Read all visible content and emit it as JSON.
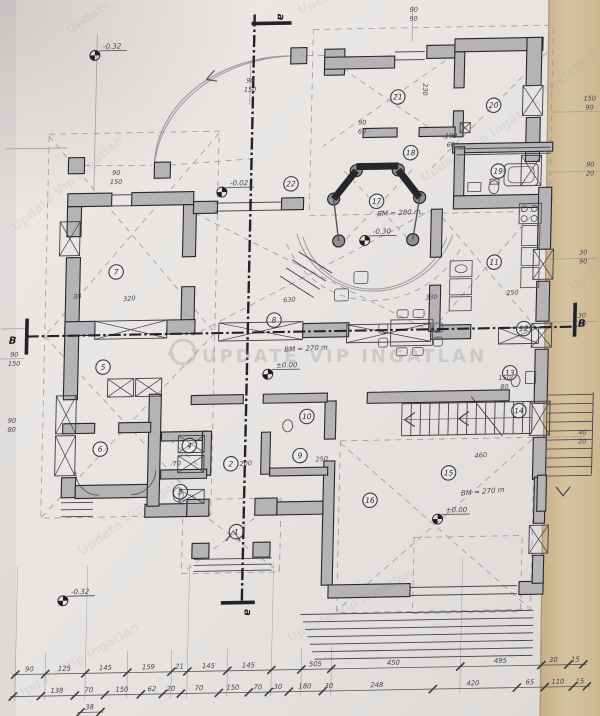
{
  "document": {
    "type_note": "scanned architectural ground floor plan photo",
    "watermark": {
      "center": "UPDATE VIP INGATLAN",
      "tile": "Update Vip Ingatlan",
      "tiles": [
        {
          "x": 70,
          "y": 35,
          "r": -35
        },
        {
          "x": 300,
          "y": 14,
          "r": -24
        },
        {
          "x": 548,
          "y": 95,
          "r": -38
        },
        {
          "x": 16,
          "y": 232,
          "r": -40
        },
        {
          "x": 574,
          "y": 292,
          "r": -40
        },
        {
          "x": 82,
          "y": 556,
          "r": -36
        },
        {
          "x": 424,
          "y": 182,
          "r": -33
        },
        {
          "x": 290,
          "y": 642,
          "r": -28
        },
        {
          "x": 18,
          "y": 700,
          "r": -30
        }
      ]
    },
    "section_markers": {
      "vertical_label": "a",
      "horizontal_label": "B",
      "vertical_positions": [
        {
          "x": 270,
          "y": 15,
          "r": 90
        },
        {
          "x": 250,
          "y": 610,
          "r": 90
        }
      ],
      "horizontal_positions": [
        {
          "x": 12,
          "y": 337,
          "r": 0
        },
        {
          "x": 581,
          "y": 330,
          "r": 0
        }
      ]
    },
    "rooms": [
      {
        "n": "1",
        "x": 240,
        "y": 529
      },
      {
        "n": "2",
        "x": 233,
        "y": 461
      },
      {
        "n": "3",
        "x": 183,
        "y": 488
      },
      {
        "n": "4",
        "x": 191,
        "y": 442
      },
      {
        "n": "5",
        "x": 103,
        "y": 362
      },
      {
        "n": "6",
        "x": 102,
        "y": 444
      },
      {
        "n": "7",
        "x": 114,
        "y": 267
      },
      {
        "n": "8",
        "x": 273,
        "y": 318
      },
      {
        "n": "9",
        "x": 302,
        "y": 454
      },
      {
        "n": "10",
        "x": 308,
        "y": 415
      },
      {
        "n": "11",
        "x": 492,
        "y": 264
      },
      {
        "n": "12",
        "x": 523,
        "y": 331
      },
      {
        "n": "13",
        "x": 510,
        "y": 375
      },
      {
        "n": "14",
        "x": 520,
        "y": 413
      },
      {
        "n": "15",
        "x": 451,
        "y": 474
      },
      {
        "n": "16",
        "x": 373,
        "y": 500
      },
      {
        "n": "17",
        "x": 373,
        "y": 201
      },
      {
        "n": "18",
        "x": 406,
        "y": 153
      },
      {
        "n": "19",
        "x": 494,
        "y": 173
      },
      {
        "n": "20",
        "x": 488,
        "y": 107
      },
      {
        "n": "21",
        "x": 392,
        "y": 97
      },
      {
        "n": "22",
        "x": 287,
        "y": 182
      }
    ],
    "level_marks": [
      {
        "t": "-0.32",
        "x": 88,
        "y": 50
      },
      {
        "t": "-0.02",
        "x": 218,
        "y": 189
      },
      {
        "t": "±0.00",
        "x": 268,
        "y": 372
      },
      {
        "t": "-0.30",
        "x": 362,
        "y": 240
      },
      {
        "t": "±0.00",
        "x": 441,
        "y": 520
      },
      {
        "t": "-0.32",
        "x": 68,
        "y": 595
      }
    ],
    "bm_notes": [
      {
        "t": "BM = 270 m",
        "x": 284,
        "y": 350,
        "r": -2
      },
      {
        "t": "BM = 280 m",
        "x": 374,
        "y": 216,
        "r": -2
      },
      {
        "t": "BM = 270 m",
        "x": 464,
        "y": 497,
        "r": -4
      }
    ],
    "dimension_rows": [
      {
        "y": 668,
        "ticks": [
          22,
          52,
          92,
          134,
          178,
          194,
          234,
          278,
          308,
          338,
          467,
          548,
          575,
          590
        ],
        "labels": [
          {
            "v": "90",
            "x": 36
          },
          {
            "v": "125",
            "x": 71
          },
          {
            "v": "145",
            "x": 112
          },
          {
            "v": "159",
            "x": 155
          },
          {
            "v": "21",
            "x": 186
          },
          {
            "v": "145",
            "x": 215
          },
          {
            "v": "145",
            "x": 255
          },
          {
            "v": "505",
            "x": 322
          },
          {
            "v": "450",
            "x": 400
          },
          {
            "v": "495",
            "x": 507
          },
          {
            "v": "30",
            "x": 560
          },
          {
            "v": "15",
            "x": 582
          }
        ]
      },
      {
        "y": 690,
        "ticks": [
          20,
          48,
          82,
          112,
          148,
          170,
          188,
          226,
          256,
          276,
          296,
          330,
          440,
          524,
          552,
          580,
          594
        ],
        "labels": [
          {
            "v": "138",
            "x": 64
          },
          {
            "v": "70",
            "x": 96
          },
          {
            "v": "150",
            "x": 129
          },
          {
            "v": "62",
            "x": 159
          },
          {
            "v": "20",
            "x": 178
          },
          {
            "v": "70",
            "x": 206
          },
          {
            "v": "150",
            "x": 240
          },
          {
            "v": "70",
            "x": 265
          },
          {
            "v": "30",
            "x": 285
          },
          {
            "v": "180",
            "x": 312
          },
          {
            "v": "30",
            "x": 336
          },
          {
            "v": "248",
            "x": 384
          },
          {
            "v": "420",
            "x": 480
          },
          {
            "v": "65",
            "x": 537
          },
          {
            "v": "110",
            "x": 565
          },
          {
            "v": "15",
            "x": 587
          }
        ]
      },
      {
        "y": 707,
        "ticks": [
          88,
          108
        ],
        "labels": [
          {
            "v": "38",
            "x": 97
          }
        ]
      }
    ],
    "scattered_dims": [
      {
        "v": "38",
        "x": 76,
        "y": 293,
        "r": -6
      },
      {
        "v": "320",
        "x": 128,
        "y": 296,
        "r": -4
      },
      {
        "v": "630",
        "x": 288,
        "y": 300,
        "r": -3
      },
      {
        "v": "330",
        "x": 430,
        "y": 300,
        "r": -3
      },
      {
        "v": "230",
        "x": 417,
        "y": 90,
        "r": 90
      },
      {
        "v": "250",
        "x": 511,
        "y": 297,
        "r": -3
      },
      {
        "v": "200",
        "x": 248,
        "y": 463,
        "r": -3
      },
      {
        "v": "70",
        "x": 179,
        "y": 462,
        "r": -3
      },
      {
        "v": "250",
        "x": 324,
        "y": 460,
        "r": -3
      },
      {
        "v": "460",
        "x": 483,
        "y": 459,
        "r": -4
      },
      {
        "v": "90",
        "x": 244,
        "y": 80,
        "r": 0
      },
      {
        "v": "150",
        "x": 244,
        "y": 89,
        "r": 0
      },
      {
        "v": "90",
        "x": 406,
        "y": 12,
        "r": 0
      },
      {
        "v": "90",
        "x": 406,
        "y": 21,
        "r": 0
      },
      {
        "v": "100",
        "x": 446,
        "y": 139,
        "r": 0
      },
      {
        "v": "60",
        "x": 446,
        "y": 148,
        "r": 0
      },
      {
        "v": "90",
        "x": 357,
        "y": 124,
        "r": 0
      },
      {
        "v": "60",
        "x": 357,
        "y": 133,
        "r": 0
      },
      {
        "v": "150",
        "x": 584,
        "y": 104,
        "r": 0
      },
      {
        "v": "90",
        "x": 584,
        "y": 113,
        "r": 0
      },
      {
        "v": "90",
        "x": 586,
        "y": 170,
        "r": 0
      },
      {
        "v": "20",
        "x": 586,
        "y": 179,
        "r": 0
      },
      {
        "v": "30",
        "x": 581,
        "y": 258,
        "r": 0
      },
      {
        "v": "90",
        "x": 581,
        "y": 267,
        "r": 0
      },
      {
        "v": "30",
        "x": 581,
        "y": 321,
        "r": 0
      },
      {
        "v": "20",
        "x": 581,
        "y": 330,
        "r": 0
      },
      {
        "v": "40",
        "x": 584,
        "y": 438,
        "r": 0
      },
      {
        "v": "20",
        "x": 584,
        "y": 447,
        "r": 0
      },
      {
        "v": "90",
        "x": 14,
        "y": 350,
        "r": 0
      },
      {
        "v": "150",
        "x": 14,
        "y": 359,
        "r": 0
      },
      {
        "v": "90",
        "x": 13,
        "y": 416,
        "r": 0
      },
      {
        "v": "80",
        "x": 13,
        "y": 425,
        "r": 0
      },
      {
        "v": "90",
        "x": 112,
        "y": 170,
        "r": 0
      },
      {
        "v": "150",
        "x": 112,
        "y": 179,
        "r": 0
      },
      {
        "v": "150",
        "x": 505,
        "y": 382,
        "r": 0
      },
      {
        "v": "80",
        "x": 505,
        "y": 391,
        "r": 0
      }
    ],
    "colors": {
      "paper": "#e8e5e3",
      "paper_dark": "#d9d6d4",
      "tan": "#d2bd97",
      "tan_dark": "#c4ad84",
      "ink": "#27262c",
      "wall_fill": "#b5b3b5",
      "pencil": "#9b97a2",
      "dim_text": "#46434e",
      "watermark": "#878d96"
    }
  }
}
